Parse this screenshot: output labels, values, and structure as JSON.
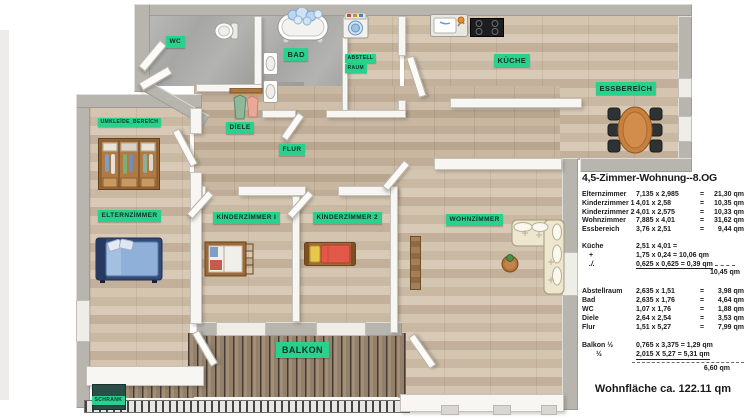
{
  "colors": {
    "label_green": "#2ad18c",
    "label_text": "#0c3029",
    "wood_light": "#cdbca7",
    "balcony_wood": "#93806a",
    "wall_gray": "#b8b5ae"
  },
  "plan": {
    "labels": {
      "wc": "WC",
      "bad": "BAD",
      "abstell_1": "ABSTELL",
      "abstell_2": "RAUM",
      "kueche": "KÜCHE",
      "essbereich": "ESSBEREİCH",
      "diele": "DİELE",
      "flur": "FLUR",
      "umkleide": "UMKLEİDE_BEREİCH",
      "elternzimmer": "ELTERNZİMMER",
      "kinderzimmer1": "KİNDERZİMMER I",
      "kinderzimmer2": "KİNDERZİMMER 2",
      "wohnzimmer": "WOHNZİMMER",
      "balkon": "BALKON",
      "schrank": "SCHRANK"
    }
  },
  "panel": {
    "title": "4,5-Zimmer-Wohnung--8.OG",
    "eq": "=",
    "main_rows": [
      {
        "name": "Elternzimmer",
        "dims": "7,135 x 2,985",
        "area": "21,30 qm"
      },
      {
        "name": "Kinderzimmer 1",
        "dims": "4,01 x 2,58",
        "area": "10,35 qm"
      },
      {
        "name": "Kinderzimmer 2",
        "dims": "4,01 x 2,575",
        "area": "10,33 qm"
      },
      {
        "name": "Wohnzimmer",
        "dims": "7,885 x 4,01",
        "area": "31,62 qm"
      },
      {
        "name": "Essbereich",
        "dims": "3,76 x 2,51",
        "area": "9,44 qm"
      }
    ],
    "kueche_rows": [
      {
        "name": "Küche",
        "dims": "2,51 x 4,01 ="
      },
      {
        "name": "+",
        "dims": "1,75 x 0,24 = 10,06 qm"
      },
      {
        "name": "./.",
        "dims": "0,625 x 0,625 = 0,39 qm"
      }
    ],
    "kueche_total": "10,45 qm",
    "aux_rows": [
      {
        "name": "Abstellraum",
        "dims": "2,635 x 1,51",
        "area": "3,98 qm"
      },
      {
        "name": "Bad",
        "dims": "2,635 x 1,76",
        "area": "4,64 qm"
      },
      {
        "name": "WC",
        "dims": "1,07 x 1,76",
        "area": "1,88 qm"
      },
      {
        "name": "Diele",
        "dims": "2,64 x 2,54",
        "area": "3,53 qm"
      },
      {
        "name": "Flur",
        "dims": "1,51 x 5,27",
        "area": "7,99 qm"
      }
    ],
    "balkon_rows": [
      {
        "name": "Balkon ½",
        "dims": "0,765 x 3,375 = 1,29 qm"
      },
      {
        "name": "½",
        "dims": "2,015 X 5,27 = 5,31 qm"
      }
    ],
    "balkon_total": "6,60 qm",
    "footer": "Wohnfläche ca. 122.11 qm"
  }
}
